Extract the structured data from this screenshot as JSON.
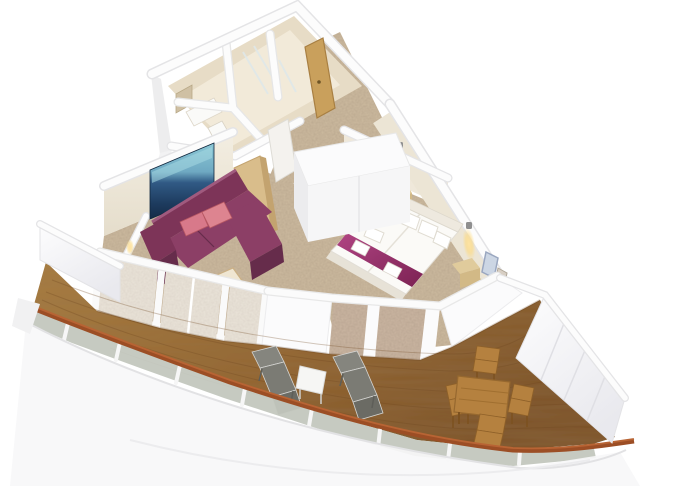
{
  "scene": {
    "title": "3D cutaway floor plan of a cruise-ship suite with wraparound balcony",
    "view": "oblique aerial render, white background",
    "background": "#ffffff"
  },
  "rooms": {
    "bathroom": {
      "features": [
        "beige-tiled-walls",
        "shower-cabin",
        "wc-room",
        "washbasin",
        "mirror-cabinet"
      ]
    },
    "entry_hall": {
      "features": [
        "tan-entry-door",
        "carpeted-corridor",
        "white-bathroom-door"
      ]
    },
    "living_room": {
      "features": [
        "sea-picture-on-wall",
        "plum-corner-sofa",
        "pink-accent-pillows",
        "light-wood-coffee-table",
        "floor-to-ceiling-window-wall",
        "tan-divider-panel"
      ]
    },
    "bedroom": {
      "features": [
        "white-double-bed",
        "magenta-bed-runner",
        "folded-towels-on-bed",
        "white-pillows",
        "two-nightstands",
        "two-glowing-wall-lamps",
        "vanity-with-mirror",
        "white-wardrobe-block"
      ]
    },
    "balcony": {
      "features": [
        "curved-teak-deck",
        "glass-railing-with-wood-cap",
        "two-sun-loungers",
        "small-white-side-table",
        "teak-dining-table",
        "four-teak-chairs",
        "white-partition-walls",
        "white-hull-band"
      ]
    }
  },
  "counts": {
    "sun_loungers": 2,
    "dining_chairs": 4,
    "bed_pillows": 5,
    "towels_on_bed": 2,
    "sofa_pillows": 2,
    "wall_lamps": 2,
    "window_panels": 3,
    "facade_textured_panels": 2
  },
  "colors": {
    "wall_white": "#fbfbfc",
    "wall_edge": "#e2e2e4",
    "wall_cream": "#efe8da",
    "tile": "#e7dcc6",
    "tile_light": "#f2ead9",
    "carpet": "#cdbb9f",
    "door_tan": "#c9a05c",
    "door_edge": "#a87f42",
    "white_door": "#f4f2ee",
    "tv_sky": "#8cc8d6",
    "tv_sea": "#1d3b5e",
    "sofa": "#8c3f66",
    "sofa_back": "#7d3458",
    "sofa_dark": "#662c4b",
    "pillow_pink": "#d8798a",
    "panel_tan": "#d9bd8b",
    "bed_white": "#fbfaf7",
    "bed_shadow": "#e7e2d7",
    "runner": "#a23574",
    "runner_dark": "#7c2253",
    "wood_light": "#e0cb9c",
    "wood_mid": "#d2b986",
    "lamp_glow": "#ffd98a",
    "deck": "#95672f",
    "deck_light": "#a97e41",
    "deck_dark": "#7c5124",
    "cap_rail": "#9c4e25",
    "rail_glass": "#c3c7be",
    "rail_white": "#f6f6f6",
    "facade_panel": "#cbb6a2",
    "glass_window": "#ddd2bf",
    "lounger": "#85857e",
    "lounger_dark": "#6b6b64",
    "teak": "#b5813f",
    "teak_dark": "#8f6129",
    "hull": "#f7f7f8",
    "hull_edge": "#e5e5e7",
    "mirror_frame": "#9aa7c0",
    "mirror_fill": "#ccd6e4",
    "toilet_white": "#fafaf8"
  }
}
